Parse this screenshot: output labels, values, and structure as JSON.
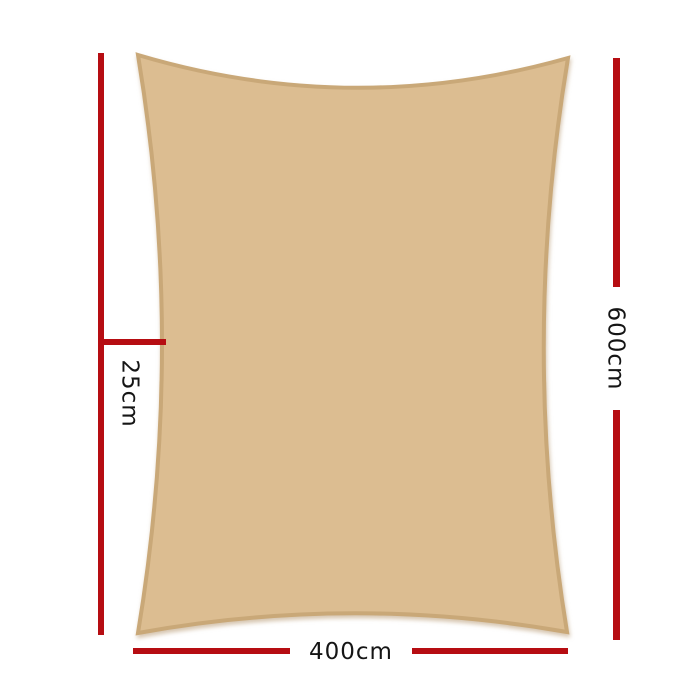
{
  "diagram": {
    "type": "product-dimensions",
    "product": "rectangle shade sail",
    "colors": {
      "background": "#ffffff",
      "sail_fill": "#dcbd91",
      "sail_border": "#c9a878",
      "dimension_line": "#b60d12",
      "label_text": "#151515"
    },
    "labels": {
      "side_offset": "25cm",
      "height": "600cm",
      "width": "400cm"
    }
  }
}
